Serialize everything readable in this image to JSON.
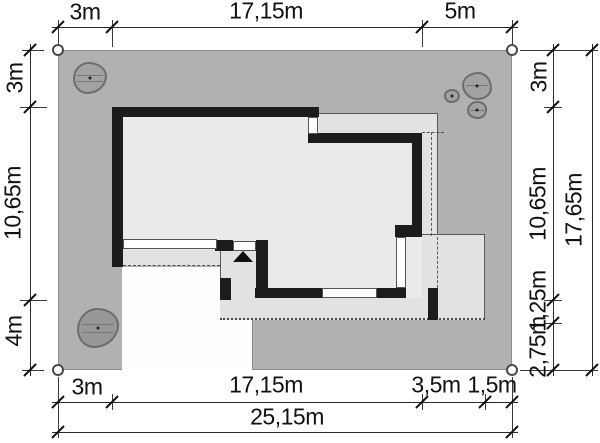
{
  "diagram": {
    "type": "architectural-site-plan",
    "description": "Plot plan with house footprint, terraces, driveway, trees and dimension chains"
  },
  "dims": {
    "top": [
      "3m",
      "17,15m",
      "5m"
    ],
    "left": [
      "3m",
      "10,65m",
      "4m"
    ],
    "right_inner": [
      "3m",
      "10,65m",
      "1,25m",
      "2,75m"
    ],
    "right_outer": "17,65m",
    "bottom_inner": [
      "3m",
      "17,15m",
      "3,5m",
      "1,5m"
    ],
    "bottom_outer": "25,15m"
  },
  "icons": {
    "entrance_arrow": "triangle-up",
    "boundary_corner": "circle",
    "tree": "blob-with-center-dot"
  },
  "colors": {
    "plot": "#b1b1b1",
    "interior": "#eaeaea",
    "paving": "#e2e2e2",
    "wall": "#1c1c1c",
    "driveway": "#fdfdfd",
    "tree_fill": "#a2a2a2",
    "tree_edge": "#6d6d6d",
    "line": "#1a1a1a"
  }
}
